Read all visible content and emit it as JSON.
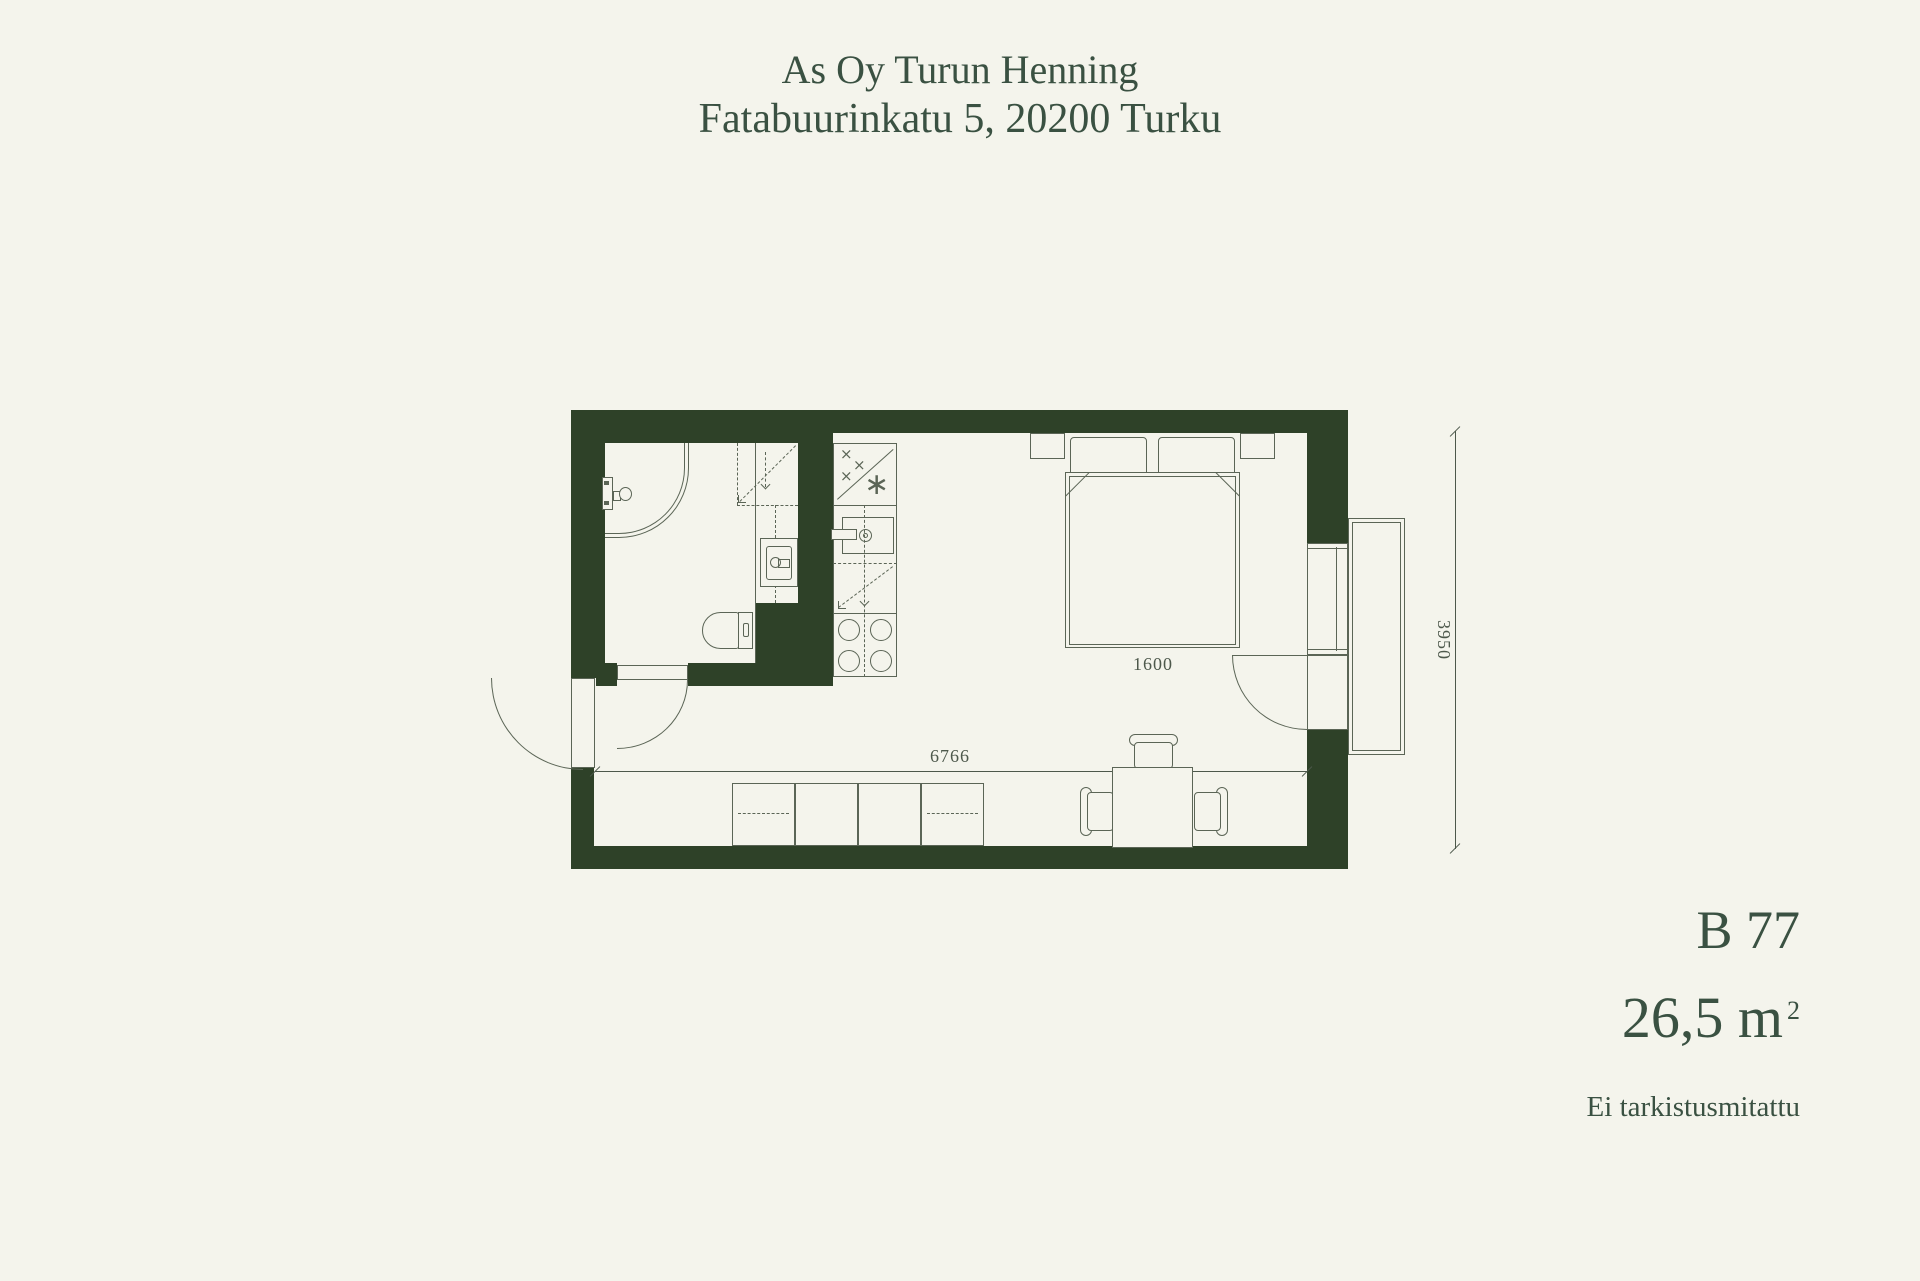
{
  "page": {
    "background_color": "#f4f4ec",
    "wall_color": "#2e4128",
    "line_color": "#5b6556",
    "text_color": "#3a5142"
  },
  "header": {
    "building_name": "As Oy Turun Henning",
    "address": "Fatabuurinkatu 5, 20200 Turku"
  },
  "unit": {
    "id": "B 77",
    "area_value": "26,5 m",
    "area_superscript": "2",
    "note": "Ei tarkistusmitattu"
  },
  "dimensions": {
    "bed_width_mm": "1600",
    "interior_width_mm": "6766",
    "interior_depth_mm": "3950"
  },
  "kitchen_symbols": {
    "cross_a": "×",
    "cross_b": "×",
    "cross_c": "×",
    "freezer_star": "∗"
  },
  "fixtures": [
    "entry-door",
    "bathroom-door",
    "shower",
    "shower-valve",
    "washing-machine-reservation",
    "washbasin",
    "toilet",
    "fridge-freezer",
    "kitchen-sink",
    "dishwasher-reservation",
    "stove",
    "wardrobe",
    "dining-table",
    "chair",
    "bed",
    "pillow",
    "nightstand",
    "balcony-door",
    "window",
    "french-balcony"
  ]
}
